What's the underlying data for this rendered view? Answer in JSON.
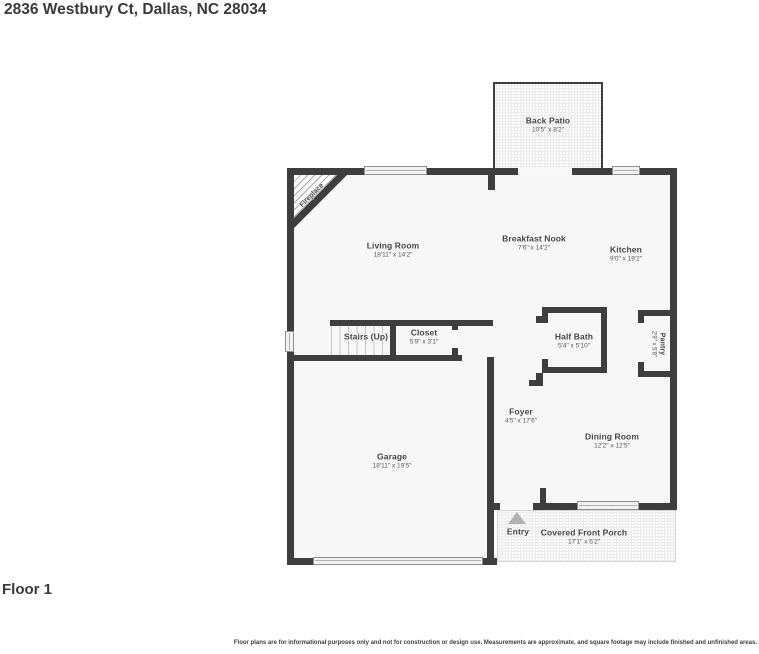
{
  "page": {
    "title": "2836 Westbury Ct, Dallas, NC 28034",
    "floor_label": "Floor 1",
    "disclaimer": "Floor plans are for informational purposes only and not for construction or design use. Measurements are approximate, and square footage may include finished and unfinished areas."
  },
  "colors": {
    "wall": "#3e3e3e",
    "room_fill": "#f7f7f7",
    "text": "#464646"
  },
  "rooms": [
    {
      "id": "back-patio",
      "name": "Back Patio",
      "dims": "10'5\" x 8'2\""
    },
    {
      "id": "living-room",
      "name": "Living Room",
      "dims": "18'11\" x 14'2\""
    },
    {
      "id": "breakfast-nook",
      "name": "Breakfast Nook",
      "dims": "7'6\" x 14'2\""
    },
    {
      "id": "kitchen",
      "name": "Kitchen",
      "dims": "9'0\" x 19'2\""
    },
    {
      "id": "stairs",
      "name": "Stairs (Up)",
      "dims": ""
    },
    {
      "id": "closet",
      "name": "Closet",
      "dims": "5'9\" x 3'1\""
    },
    {
      "id": "half-bath",
      "name": "Half Bath",
      "dims": "5'4\" x 5'10\""
    },
    {
      "id": "pantry",
      "name": "Pantry",
      "dims": "2'9\" x 5'8\""
    },
    {
      "id": "foyer",
      "name": "Foyer",
      "dims": "4'5\" x 17'6\""
    },
    {
      "id": "garage",
      "name": "Garage",
      "dims": "18'11\" x 19'5\""
    },
    {
      "id": "dining-room",
      "name": "Dining Room",
      "dims": "12'2\" x 12'5\""
    },
    {
      "id": "entry",
      "name": "Entry",
      "dims": ""
    },
    {
      "id": "front-porch",
      "name": "Covered Front Porch",
      "dims": "17'1\" x 5'2\""
    },
    {
      "id": "fireplace",
      "name": "Fireplace",
      "dims": ""
    }
  ]
}
